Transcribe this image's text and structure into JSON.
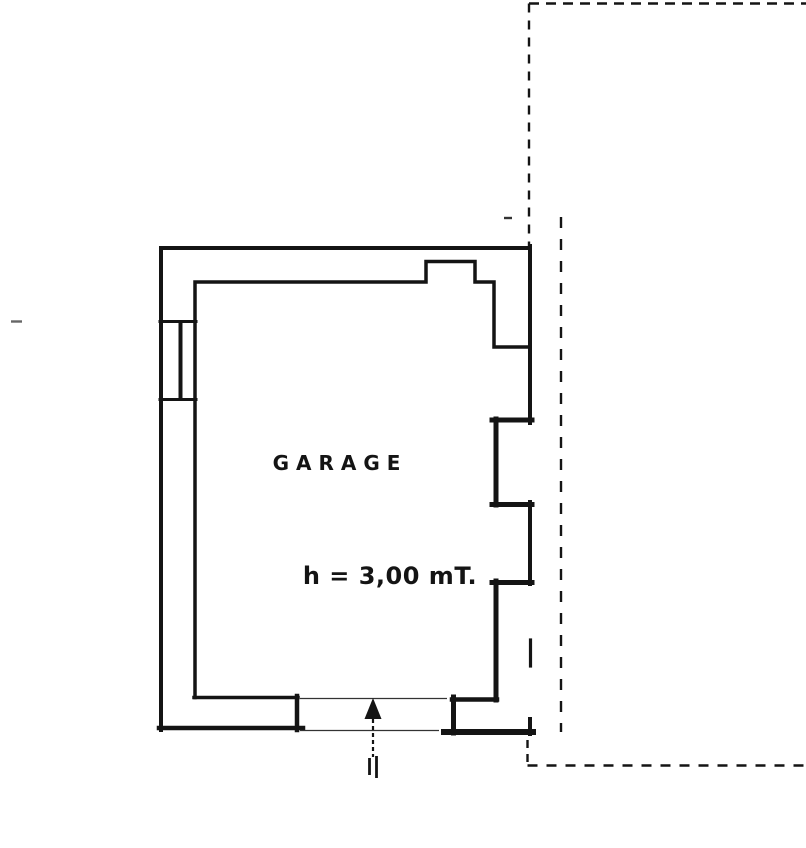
{
  "plan": {
    "room_label": "GARAGE",
    "height_label": "h = 3,00 mT."
  },
  "colors": {
    "ink": "#141414",
    "paper": "#ffffff",
    "faint_mark": "#666666"
  }
}
